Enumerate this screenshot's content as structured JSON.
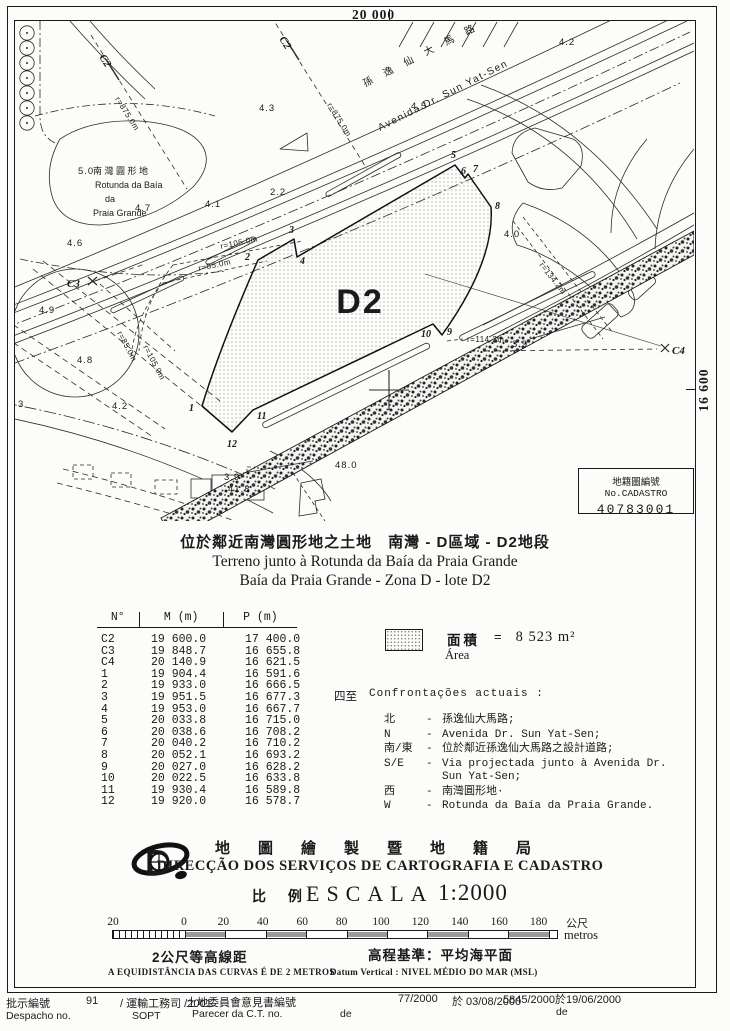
{
  "page": {
    "grid_top": "20 000",
    "grid_right": "16 600"
  },
  "map": {
    "parcel_label": "D2",
    "road_name_zh": "孫 逸 仙 大 馬 路",
    "road_name_pt": "Avenida  Dr.  Sun  Yat-Sen",
    "rotunda_line1": "南 灣 圓 形 地",
    "rotunda_line2": "Rotunda da Baía",
    "rotunda_line3": "da",
    "rotunda_line4": "Praia Grande",
    "control_points": [
      "C2",
      "C2",
      "C3",
      "C4"
    ],
    "radius_labels": [
      "r=875.0m",
      "r=875.0m",
      "r=105.0m",
      "r=85.0m",
      "r=85.0m",
      "r=105.0m",
      "r=114.2m",
      "r=134.2m"
    ],
    "vertex_labels": [
      "1",
      "2",
      "3",
      "4",
      "5",
      "6",
      "7",
      "8",
      "9",
      "10",
      "11",
      "12"
    ],
    "spot_heights": [
      "4.3",
      "4.5",
      "4.2",
      "4.1",
      "2.2",
      "4.6",
      "4.9",
      "4.8",
      "4.2",
      "4.0",
      "3.9",
      "3.9",
      "48.0",
      "41.8",
      "3",
      "5.0",
      "4.7"
    ]
  },
  "cadastro_box": {
    "label": "地籍圖編號 No.CADASTRO",
    "number": "40783001"
  },
  "title": {
    "zh": "位於鄰近南灣圓形地之土地　南灣 - D區域 - D2地段",
    "pt1": "Terreno junto à Rotunda da Baía da Praia Grande",
    "pt2": "Baía da Praia Grande - Zona D - lote D2"
  },
  "table": {
    "headers": [
      "N°",
      "M (m)",
      "P (m)"
    ],
    "rows": [
      [
        "C2",
        "19 600.0",
        "17 400.0"
      ],
      [
        "C3",
        "19 848.7",
        "16 655.8"
      ],
      [
        "C4",
        "20 140.9",
        "16 621.5"
      ],
      [
        "1",
        "19 904.4",
        "16 591.6"
      ],
      [
        "2",
        "19 933.0",
        "16 666.5"
      ],
      [
        "3",
        "19 951.5",
        "16 677.3"
      ],
      [
        "4",
        "19 953.0",
        "16 667.7"
      ],
      [
        "5",
        "20 033.8",
        "16 715.0"
      ],
      [
        "6",
        "20 038.6",
        "16 708.2"
      ],
      [
        "7",
        "20 040.2",
        "16 710.2"
      ],
      [
        "8",
        "20 052.1",
        "16 693.2"
      ],
      [
        "9",
        "20 027.0",
        "16 628.2"
      ],
      [
        "10",
        "20 022.5",
        "16 633.8"
      ],
      [
        "11",
        "19 930.4",
        "16 589.8"
      ],
      [
        "12",
        "19 920.0",
        "16 578.7"
      ]
    ]
  },
  "area": {
    "zh": "面積",
    "eq": "=",
    "value": "8 523 m²",
    "pt": "Área"
  },
  "confrontacoes": {
    "prefix": "四至",
    "title": "Confrontações actuais :",
    "rows": [
      {
        "dir": "北",
        "text": "孫逸仙大馬路;"
      },
      {
        "dir": "N",
        "text": "Avenida Dr. Sun Yat-Sen;"
      },
      {
        "dir": "南/東",
        "text": "位於鄰近孫逸仙大馬路之設計道路;"
      },
      {
        "dir": "S/E",
        "text": "Via projectada junto à Avenida Dr. Sun Yat-Sen;"
      },
      {
        "dir": "西",
        "text": "南灣圓形地·"
      },
      {
        "dir": "W",
        "text": "Rotunda da Baía da Praia Grande."
      }
    ]
  },
  "agency": {
    "zh": "地圖繪製暨地籍局",
    "pt": "DIRECÇÃO DOS SERVIÇOS DE CARTOGRAFIA E CADASTRO",
    "scale_zh": "比 例",
    "scale_label": "ESCALA",
    "scale_value": "1:2000"
  },
  "scalebar": {
    "ticks": [
      "20",
      "0",
      "20",
      "40",
      "60",
      "80",
      "100",
      "120",
      "140",
      "160",
      "180"
    ],
    "unit_zh": "公尺",
    "unit_pt": "metros",
    "contour_zh": "2公尺等高線距",
    "contour_pt": "A EQUIDISTÂNCIA DAS CURVAS É DE 2 METROS",
    "datum_zh": "高程基準：平均海平面",
    "datum_pt": "Datum Vertical : NIVEL MÉDIO DO MAR (MSL)"
  },
  "footer": {
    "despacho_zh": "批示編號",
    "despacho_no": "91",
    "despacho_dept": "/ 運輸工務司 /2001",
    "despacho_pt": "Despacho no.",
    "despacho_sopt": "SOPT",
    "parecer_zh": "土地委員會意見書編號",
    "parecer_no": "77/2000",
    "parecer_date": "於 03/08/2000",
    "parecer_pt": "Parecer da C.T. no.",
    "parecer_de": "de",
    "ref_no": "5845/2000於19/06/2000",
    "ref_de": "de"
  }
}
